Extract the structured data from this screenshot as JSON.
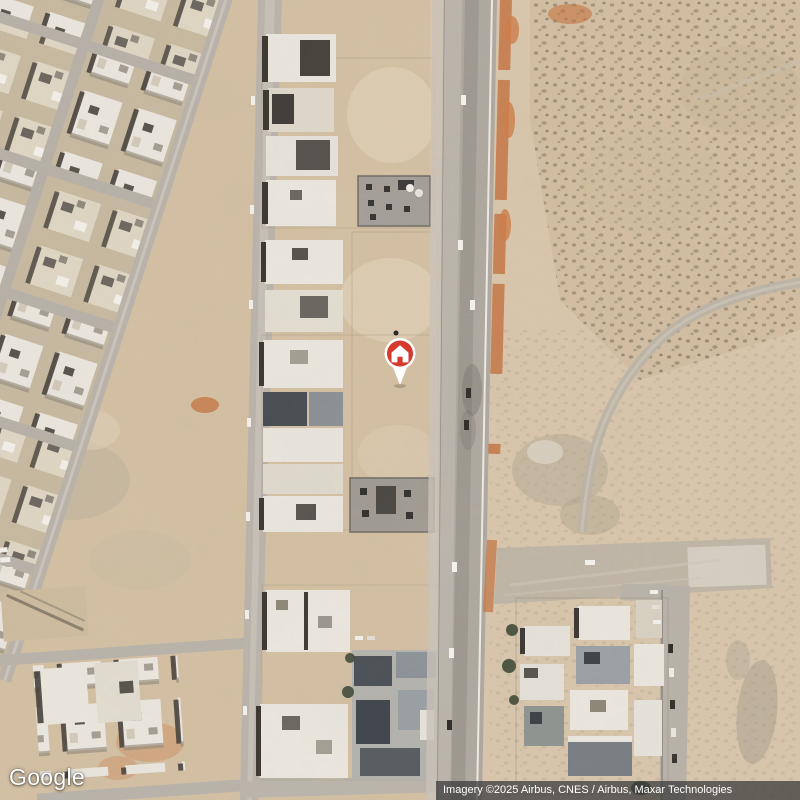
{
  "app": {
    "name": "Google Maps satellite view"
  },
  "map": {
    "view_type": "satellite",
    "scene": "desert town with urban blocks, a vertical highway and open desert",
    "pin": {
      "kind": "saved-home-place-marker",
      "glyph": "house",
      "color_hex": "#d6392e"
    }
  },
  "branding": {
    "logo_text": "Google"
  },
  "attribution": {
    "text": "Imagery ©2025 Airbus, CNES / Airbus, Maxar Technologies"
  },
  "colors": {
    "pin_red": "#d6392e",
    "pin_outline": "#ffffff",
    "attribution_bg": "rgba(60,60,60,0.75)",
    "attribution_text": "#ffffff",
    "logo_text_color": "#ffffff"
  }
}
